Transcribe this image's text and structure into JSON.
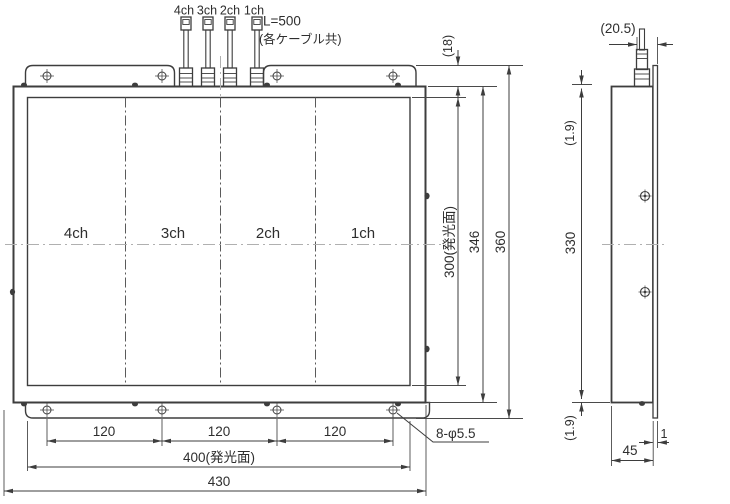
{
  "front_view": {
    "cable_labels": [
      "4ch",
      "3ch",
      "2ch",
      "1ch"
    ],
    "cable_length_note": "L=500",
    "cable_length_note2": "(各ケーブル共)",
    "channel_labels": [
      "4ch",
      "3ch",
      "2ch",
      "1ch"
    ],
    "dim_bracket_offset": "(18)",
    "dim_emitting_height": "300(発光面)",
    "dim_body_height": "346",
    "dim_overall_height": "360",
    "dim_hole_pitch": [
      "120",
      "120",
      "120"
    ],
    "dim_emitting_width": "400(発光面)",
    "dim_overall_width": "430",
    "dim_mounting_holes": "8-φ5.5"
  },
  "side_view": {
    "dim_connector_offset": "(20.5)",
    "dim_plate_offset_top": "(1.9)",
    "dim_hole_span": "330",
    "dim_plate_offset_bottom": "(1.9)",
    "dim_depth": "45",
    "dim_plate_thickness": "1"
  },
  "colors": {
    "line": "#3d3d3d",
    "centerline": "#b0b0b0",
    "background": "#ffffff"
  }
}
